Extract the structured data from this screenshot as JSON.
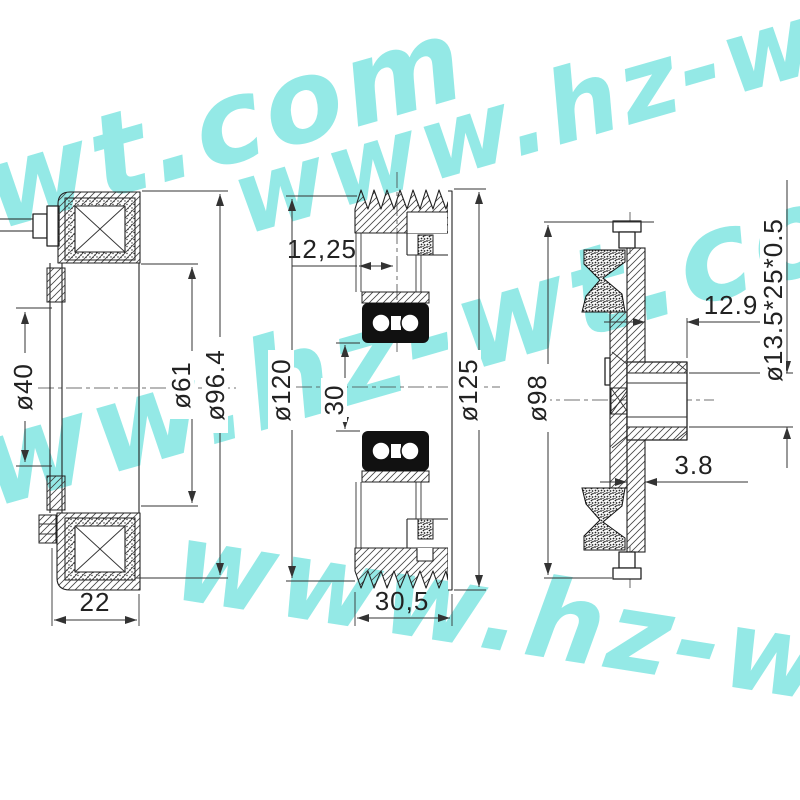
{
  "watermark": {
    "text": "www.hz-wt.com",
    "color": "#4edcd6"
  },
  "drawing": {
    "line_color": "#222222",
    "coil_view": {
      "dims": {
        "bore": "ø40",
        "coil_inner": "ø61",
        "outer": "ø96.4",
        "depth": "22"
      }
    },
    "pulley_view": {
      "dims": {
        "bearing_offset": "12,25",
        "bearing_bore": "30",
        "groove_dia": "ø120",
        "outer_dia": "ø125",
        "width": "30,5"
      }
    },
    "hub_view": {
      "dims": {
        "plate_dia": "ø98",
        "hub_depth": "12.9",
        "plate_thickness": "3.8",
        "spline_spec": "ø13.5*25*0.5"
      }
    }
  }
}
